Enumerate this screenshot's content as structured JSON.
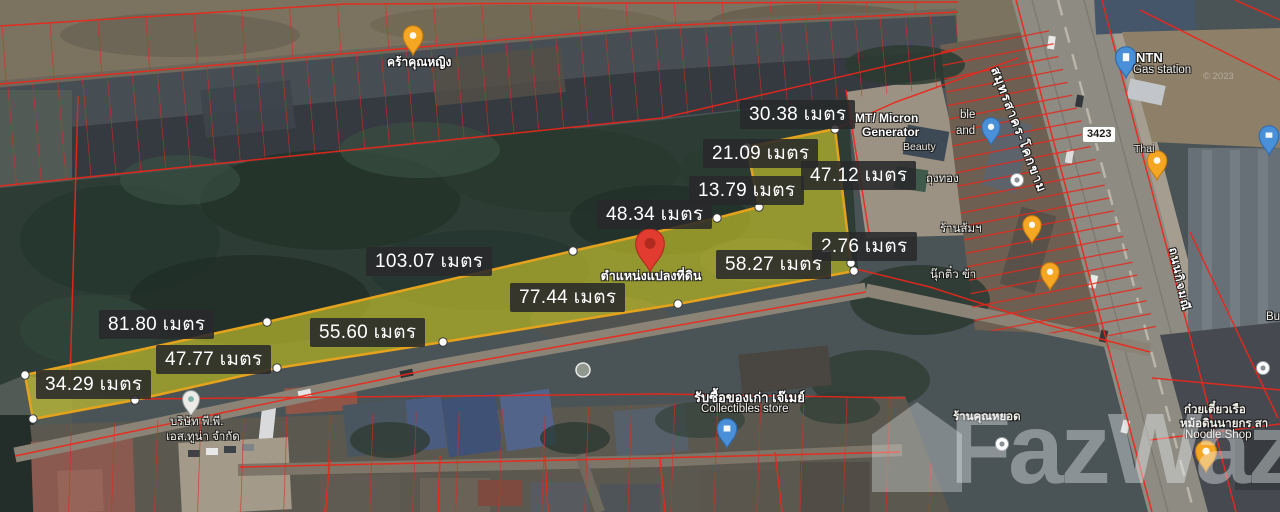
{
  "map": {
    "watermark": {
      "label": "FazWaz"
    },
    "attribution": {
      "label": "© 2023"
    },
    "plot": {
      "pin_label": "ตำแหน่งแปลงที่ดิน",
      "unit": "เมตร",
      "highlight_color": "#d8d42c",
      "outline_color": "#e5a31d",
      "measurements": [
        {
          "label": "30.38 เมตร"
        },
        {
          "label": "21.09 เมตร"
        },
        {
          "label": "47.12 เมตร"
        },
        {
          "label": "13.79 เมตร"
        },
        {
          "label": "48.34 เมตร"
        },
        {
          "label": "103.07 เมตร"
        },
        {
          "label": "2.76 เมตร"
        },
        {
          "label": "58.27 เมตร"
        },
        {
          "label": "77.44 เมตร"
        },
        {
          "label": "81.80 เมตร"
        },
        {
          "label": "55.60 เมตร"
        },
        {
          "label": "47.77 เมตร"
        },
        {
          "label": "34.29 เมตร"
        }
      ]
    },
    "roads": {
      "route_sign": {
        "label": "3423"
      },
      "main_road": {
        "label": "สมุทรสาคร-โคกขาม"
      },
      "side_road": {
        "label": "ถนนกิจมณี"
      }
    },
    "places": {
      "kra_khunying": {
        "label": "คร้าคุณหญิง"
      },
      "mt_micron": {
        "line1": "MT/ Micron",
        "line2": "Generator",
        "line3": "Beauty"
      },
      "frag_ble": {
        "label": "ble"
      },
      "frag_and": {
        "label": "and"
      },
      "thung_thong": {
        "label": "ถุงทอง"
      },
      "ran_som": {
        "label": "ร้านส้มฯ"
      },
      "nuk_tim": {
        "label": "นุ๊กติ๋ว ข้า"
      },
      "ntn": {
        "name": "NTN",
        "type": "Gas station"
      },
      "thai_frag": {
        "label": "Thai"
      },
      "frag_bu": {
        "label": "Bu"
      },
      "ran_khun_yod": {
        "label": "ร้านคุณหยอด"
      },
      "collectibles": {
        "line1": "รับซื้อของเก่า เจ๊เมย์",
        "line2": "Collectibles store"
      },
      "company": {
        "line1": "บริษัท พี.พี.",
        "line2": "เอส.ทูน่า จำกัด"
      },
      "noodle_shop": {
        "line1": "ก๋วยเตี๋ยวเรือ",
        "line2": "หม้อดินนายกร สา",
        "line3": "Noodle Shop"
      }
    },
    "colors": {
      "cadastral_line": "#ee2619",
      "plot_fill": "#d8d42c",
      "plot_stroke": "#e5a31d",
      "measure_bg": "#28282a",
      "main_pin": "#e23b30"
    }
  }
}
